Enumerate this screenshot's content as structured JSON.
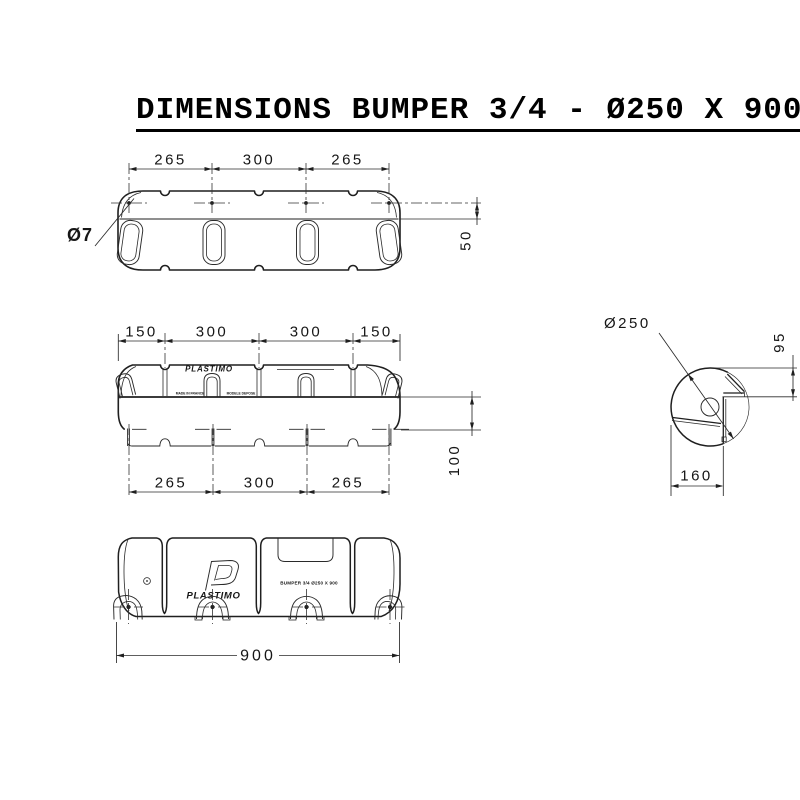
{
  "title": "DIMENSIONS BUMPER 3/4 - Ø250 X 900",
  "colors": {
    "line": "#1f1f1f",
    "background": "#ffffff"
  },
  "top_view": {
    "dims_top": [
      "265",
      "300",
      "265"
    ],
    "hole_label": "Ø7",
    "height_dim": "50"
  },
  "side_view": {
    "dims_top": [
      "150",
      "300",
      "300",
      "150"
    ],
    "dims_bottom": [
      "265",
      "300",
      "265"
    ],
    "height_dim": "100",
    "embossed_logo": "PLASTIMO",
    "embossed_left": "MADE IN FRANCE",
    "embossed_right": "MODELE DEPOSE"
  },
  "section_view": {
    "diameter_dim": "Ø250",
    "height_dim": "95",
    "width_dim": "160"
  },
  "front_view": {
    "logo_text": "PLASTIMO",
    "product_text": "BUMPER 3/4 Ø250 X 900",
    "length_dim": "900"
  }
}
